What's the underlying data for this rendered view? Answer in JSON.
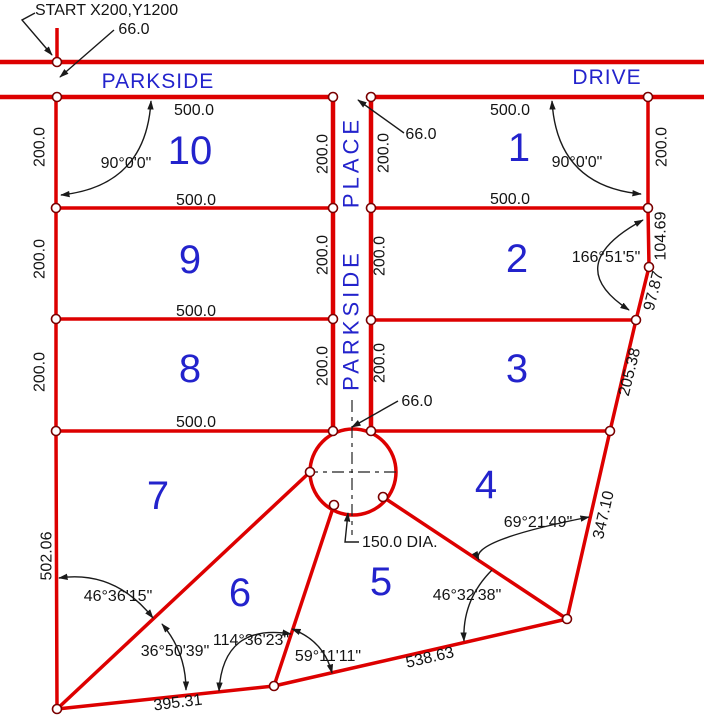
{
  "drawing": {
    "start_annotation": "START  X200,Y1200",
    "street_width": "66.0",
    "cul_de_sac_diameter": "150.0  DIA."
  },
  "street_names": {
    "parkside": "PARKSIDE",
    "drive": "DRIVE",
    "place": "PLACE"
  },
  "lot_numbers": [
    "1",
    "2",
    "3",
    "4",
    "5",
    "6",
    "7",
    "8",
    "9",
    "10"
  ],
  "dimensions": {
    "frontage": "500.0",
    "depth": "200.0",
    "west_boundary": "502.06",
    "south_boundary_west": "395.31",
    "south_boundary_east": "538.63",
    "east_boundary_lower": "347.10",
    "east_boundary_mid": "205.38",
    "east_boundary_bend": "97.87",
    "east_boundary_upper": "104.69"
  },
  "angles": {
    "lot10_northwest": "90°0'0\"",
    "lot1_northeast": "90°0'0\"",
    "east_bend": "166°51'5\"",
    "lot4_southeast": "69°21'49\"",
    "lot5_southeast": "46°32'38\"",
    "lot5_southwest": "59°11'11\"",
    "lot6_south": "114°36'23\"",
    "lot6_southwest": "36°50'39\"",
    "lot7_southwest": "46°36'15\""
  },
  "colors": {
    "line_red": "#dd0000",
    "label_blue": "#2323cc",
    "annotation_black": "#1a1a1a"
  }
}
